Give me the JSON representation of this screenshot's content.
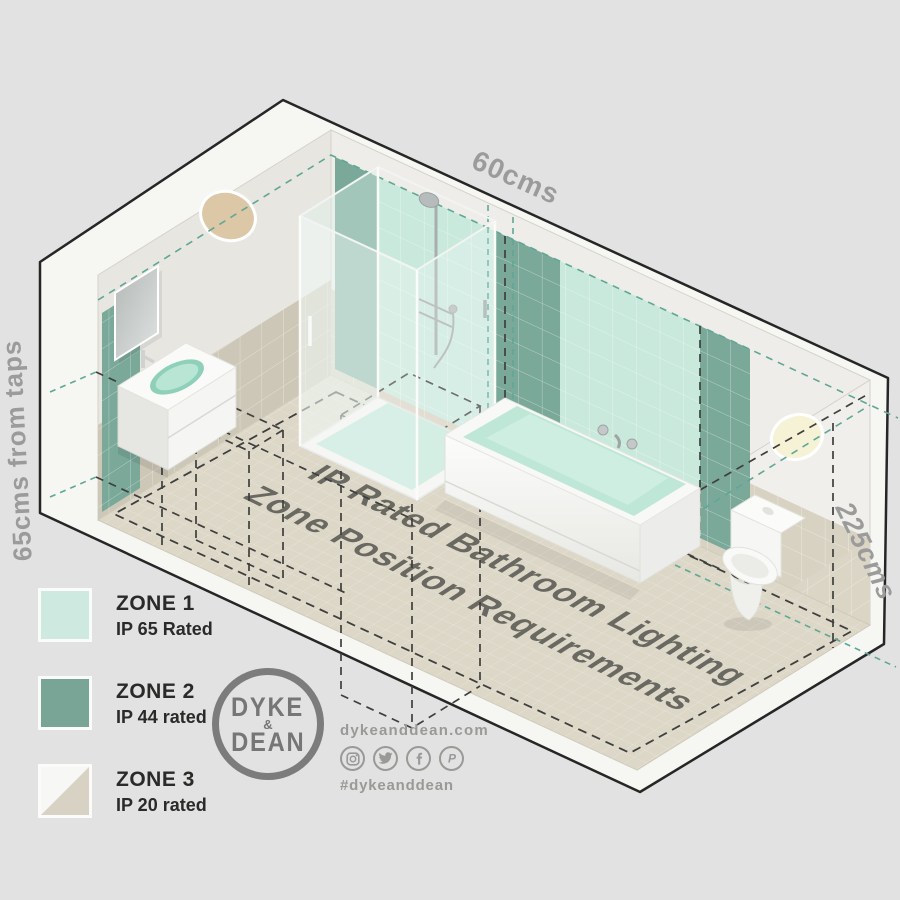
{
  "diagram": {
    "floor_title_line1": "IP Rated Bathroom Lighting",
    "floor_title_line2": "Zone Position Requirements",
    "dim_top": "60cms",
    "dim_left": "65cms from taps",
    "dim_right": "225cms",
    "colors": {
      "zone1_mint": "#c9e9dc",
      "zone2_green": "#7aa899",
      "wall_white": "#efede9",
      "wall_left": "#e8e6e1",
      "wall_right": "#f1efeb",
      "tile_wainscot": "#d8d2c2",
      "tile_wainscot_left": "#cdc7b7",
      "floor_tan": "#dcd7c7",
      "dash_dark": "#3f3f3d",
      "dash_teal": "#5fa795",
      "dim_text": "#9b9b9b",
      "floor_text": "#5a5953",
      "light_left": "#dcc7a6",
      "light_right": "#f6f2d6"
    }
  },
  "legend": {
    "items": [
      {
        "zone": "ZONE 1",
        "rating": "IP 65 Rated",
        "color": "#cde9e0"
      },
      {
        "zone": "ZONE 2",
        "rating": "IP 44 rated",
        "color": "#79a596"
      },
      {
        "zone": "ZONE 3",
        "rating": "IP 20 rated",
        "color_top": "#f7f7f5",
        "color_bottom": "#d7d2c3"
      }
    ]
  },
  "branding": {
    "logo_top": "DYKE",
    "logo_amp": "&",
    "logo_bottom": "DEAN",
    "website": "dykeanddean.com",
    "hashtag": "#dykeanddean",
    "social_icons": [
      "instagram-icon",
      "twitter-icon",
      "facebook-icon",
      "pinterest-icon"
    ]
  }
}
